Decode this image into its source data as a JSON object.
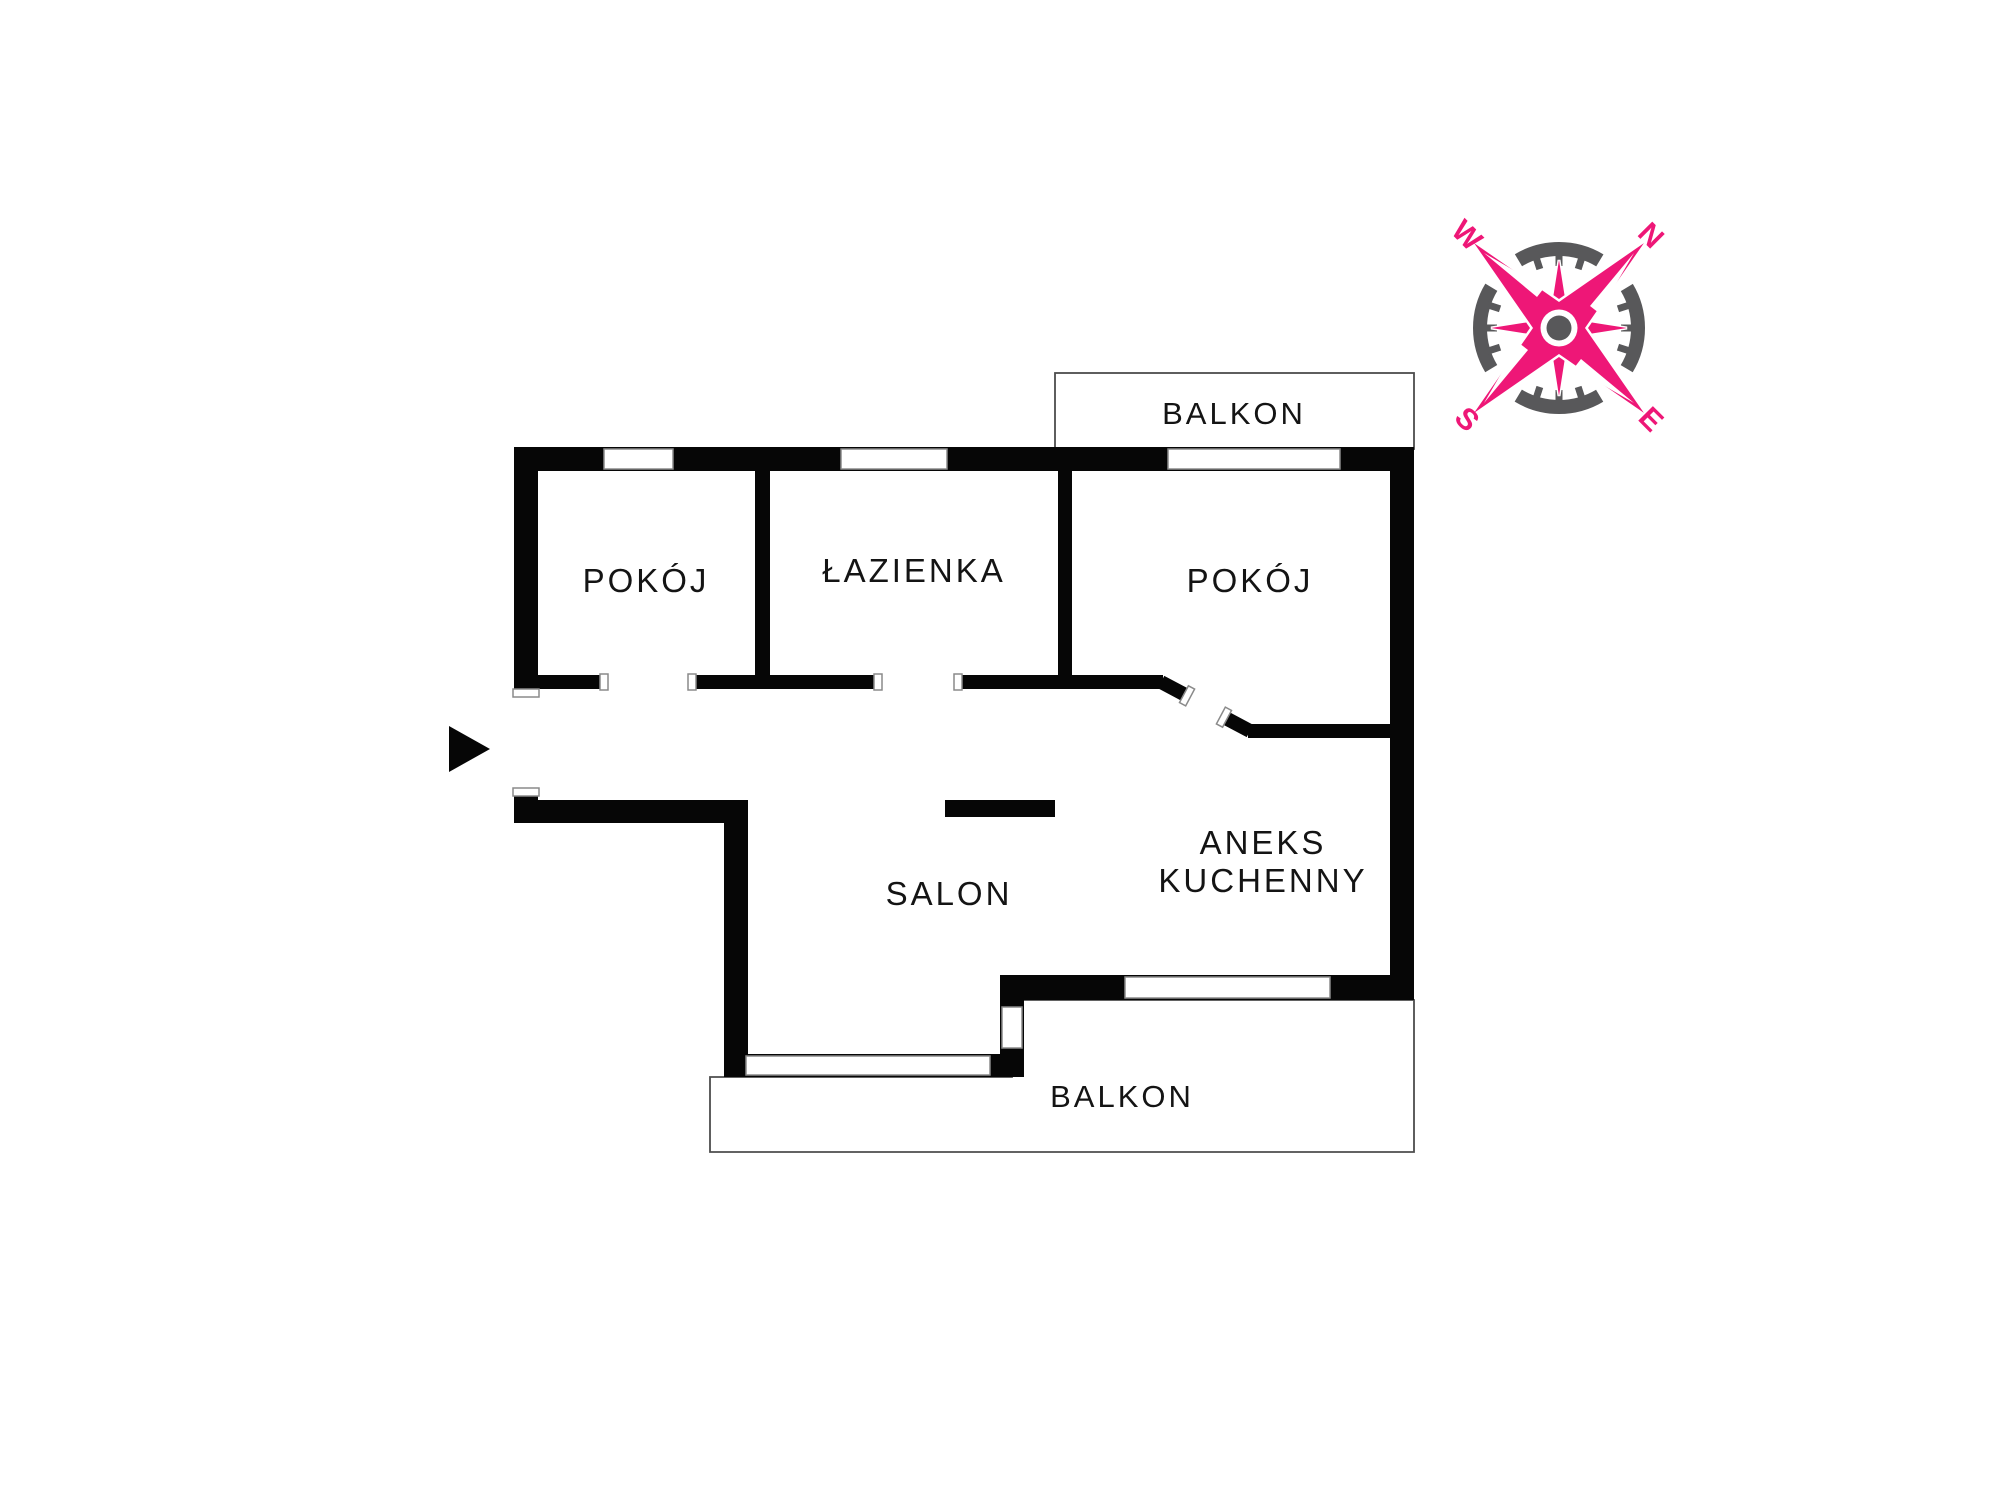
{
  "floorplan": {
    "wall_color": "#060606",
    "rooms": [
      {
        "id": "pokoj-left",
        "label": "POKÓJ"
      },
      {
        "id": "lazienka",
        "label": "ŁAZIENKA"
      },
      {
        "id": "pokoj-right",
        "label": "POKÓJ"
      },
      {
        "id": "salon",
        "label": "SALON"
      },
      {
        "id": "balkon-top",
        "label": "BALKON"
      },
      {
        "id": "balkon-bottom",
        "label": "BALKON"
      }
    ],
    "aneks": {
      "line1": "ANEKS",
      "line2": "KUCHENNY"
    },
    "entrance_arrow": "right-pointing-triangle"
  },
  "compass": {
    "rose_color": "#ee1777",
    "ring_color": "#58585a",
    "letters": {
      "n": "N",
      "e": "E",
      "s": "S",
      "w": "W"
    }
  }
}
